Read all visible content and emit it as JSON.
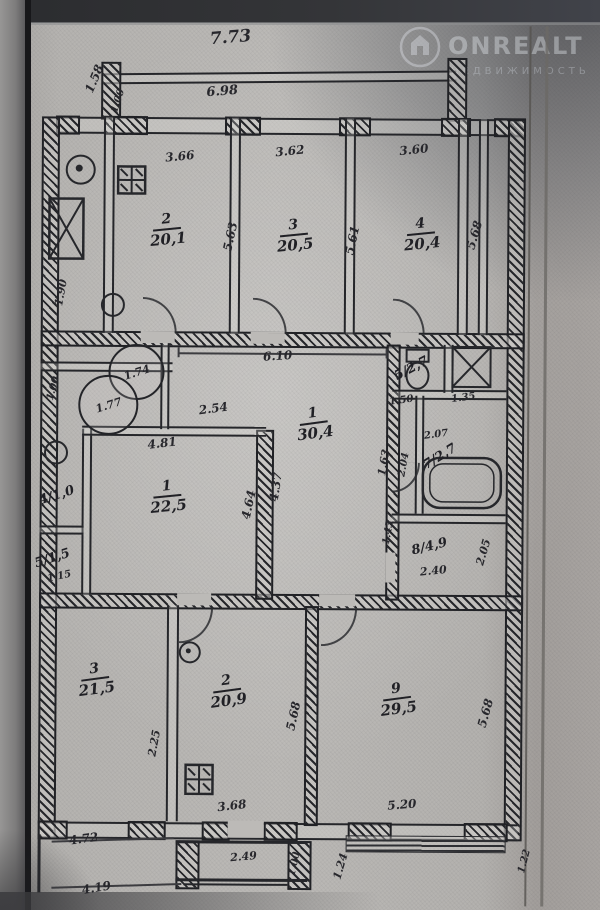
{
  "watermark": {
    "brand": "ONREALT",
    "subtitle": "НЕДВИЖИМОСТЬ",
    "icon": "house-in-circle-icon"
  },
  "plan": {
    "rooms": [
      {
        "name": "room-2-top",
        "num": "2",
        "area": "20,1",
        "x": 166,
        "y": 231,
        "r": -6,
        "style": "stack"
      },
      {
        "name": "room-3-top",
        "num": "3",
        "area": "20,5",
        "x": 293,
        "y": 236,
        "r": -6,
        "style": "stack"
      },
      {
        "name": "room-4-top",
        "num": "4",
        "area": "20,4",
        "x": 420,
        "y": 234,
        "r": -6,
        "style": "stack"
      },
      {
        "name": "room-1-hall",
        "num": "1",
        "area": "30,4",
        "x": 314,
        "y": 424,
        "r": -8,
        "style": "stack"
      },
      {
        "name": "room-1-left",
        "num": "1",
        "area": "22,5",
        "x": 168,
        "y": 498,
        "r": -6,
        "style": "stack"
      },
      {
        "name": "room-5-wc",
        "num": "5",
        "area": "2,7",
        "x": 411,
        "y": 368,
        "r": -28,
        "style": "slash"
      },
      {
        "name": "room-7-bath",
        "num": "7",
        "area": "2,7",
        "x": 440,
        "y": 456,
        "r": -32,
        "style": "slash"
      },
      {
        "name": "room-8-kitchen",
        "num": "8",
        "area": "4,9",
        "x": 430,
        "y": 546,
        "r": -14,
        "style": "slash"
      },
      {
        "name": "room-4-wc-left",
        "num": "4",
        "area": "1,0",
        "x": 57,
        "y": 497,
        "r": -18,
        "style": "slash"
      },
      {
        "name": "room-5-left",
        "num": "5",
        "area": "1,5",
        "x": 53,
        "y": 560,
        "r": -18,
        "style": "slash"
      },
      {
        "name": "room-3-bottom",
        "num": "3",
        "area": "21,5",
        "x": 97,
        "y": 681,
        "r": -8,
        "style": "stack"
      },
      {
        "name": "room-2-bottom",
        "num": "2",
        "area": "20,9",
        "x": 229,
        "y": 692,
        "r": -8,
        "style": "stack"
      },
      {
        "name": "room-9-bottom",
        "num": "9",
        "area": "29,5",
        "x": 399,
        "y": 699,
        "r": -8,
        "style": "stack"
      }
    ],
    "circled_values": [
      {
        "label": "1.74",
        "cx": 134,
        "cy": 371,
        "r": 26
      },
      {
        "label": "1.77",
        "cx": 106,
        "cy": 404,
        "r": 28
      }
    ],
    "dims": [
      {
        "t": "7.73",
        "x": 228,
        "y": 38,
        "r": -5,
        "s": 17
      },
      {
        "t": "6.98",
        "x": 220,
        "y": 92,
        "r": -5,
        "s": 13
      },
      {
        "t": "1.58",
        "x": 92,
        "y": 80,
        "r": -68,
        "s": 12
      },
      {
        "t": "1.00",
        "x": 116,
        "y": 102,
        "r": -72,
        "s": 10
      },
      {
        "t": "3.66",
        "x": 178,
        "y": 157,
        "r": -6,
        "s": 12
      },
      {
        "t": "3.62",
        "x": 288,
        "y": 151,
        "r": -6,
        "s": 12
      },
      {
        "t": "3.60",
        "x": 412,
        "y": 149,
        "r": -6,
        "s": 12
      },
      {
        "t": "5.63",
        "x": 229,
        "y": 237,
        "r": -78,
        "s": 12
      },
      {
        "t": "5.61",
        "x": 351,
        "y": 240,
        "r": -78,
        "s": 12
      },
      {
        "t": "5.68",
        "x": 473,
        "y": 234,
        "r": -74,
        "s": 12
      },
      {
        "t": "1.90",
        "x": 60,
        "y": 294,
        "r": -80,
        "s": 11
      },
      {
        "t": "6.10",
        "x": 277,
        "y": 356,
        "r": -4,
        "s": 12
      },
      {
        "t": "2.54",
        "x": 213,
        "y": 409,
        "r": -8,
        "s": 12
      },
      {
        "t": "1.00",
        "x": 53,
        "y": 390,
        "r": -75,
        "s": 10
      },
      {
        "t": "4.81",
        "x": 162,
        "y": 444,
        "r": -7,
        "s": 12
      },
      {
        "t": "4.64",
        "x": 249,
        "y": 505,
        "r": -78,
        "s": 12
      },
      {
        "t": "4.37",
        "x": 276,
        "y": 487,
        "r": -82,
        "s": 12
      },
      {
        "t": "1.63",
        "x": 384,
        "y": 462,
        "r": -80,
        "s": 11
      },
      {
        "t": "1.50",
        "x": 401,
        "y": 400,
        "r": -8,
        "s": 10
      },
      {
        "t": "1.35",
        "x": 463,
        "y": 397,
        "r": -8,
        "s": 10
      },
      {
        "t": "2.07",
        "x": 436,
        "y": 434,
        "r": -8,
        "s": 10
      },
      {
        "t": "2.04",
        "x": 404,
        "y": 464,
        "r": -80,
        "s": 10
      },
      {
        "t": "1.43",
        "x": 389,
        "y": 532,
        "r": -80,
        "s": 10
      },
      {
        "t": "2.40",
        "x": 434,
        "y": 570,
        "r": -6,
        "s": 11
      },
      {
        "t": "2.05",
        "x": 484,
        "y": 551,
        "r": -74,
        "s": 11
      },
      {
        "t": "1.15",
        "x": 60,
        "y": 578,
        "r": -12,
        "s": 10
      },
      {
        "t": "2.25",
        "x": 156,
        "y": 744,
        "r": -80,
        "s": 11
      },
      {
        "t": "5.68",
        "x": 295,
        "y": 716,
        "r": -78,
        "s": 12
      },
      {
        "t": "3.68",
        "x": 234,
        "y": 806,
        "r": -7,
        "s": 12
      },
      {
        "t": "5.68",
        "x": 487,
        "y": 712,
        "r": -75,
        "s": 12
      },
      {
        "t": "5.20",
        "x": 404,
        "y": 804,
        "r": -5,
        "s": 12
      },
      {
        "t": "4.72",
        "x": 86,
        "y": 840,
        "r": -8,
        "s": 12
      },
      {
        "t": "4.19",
        "x": 99,
        "y": 889,
        "r": -10,
        "s": 12
      },
      {
        "t": "2.49",
        "x": 246,
        "y": 857,
        "r": -5,
        "s": 11
      },
      {
        "t": "1.00",
        "x": 297,
        "y": 864,
        "r": -78,
        "s": 10
      },
      {
        "t": "1.24",
        "x": 343,
        "y": 866,
        "r": -74,
        "s": 11
      },
      {
        "t": "1.22",
        "x": 527,
        "y": 860,
        "r": -76,
        "s": 10
      }
    ]
  }
}
